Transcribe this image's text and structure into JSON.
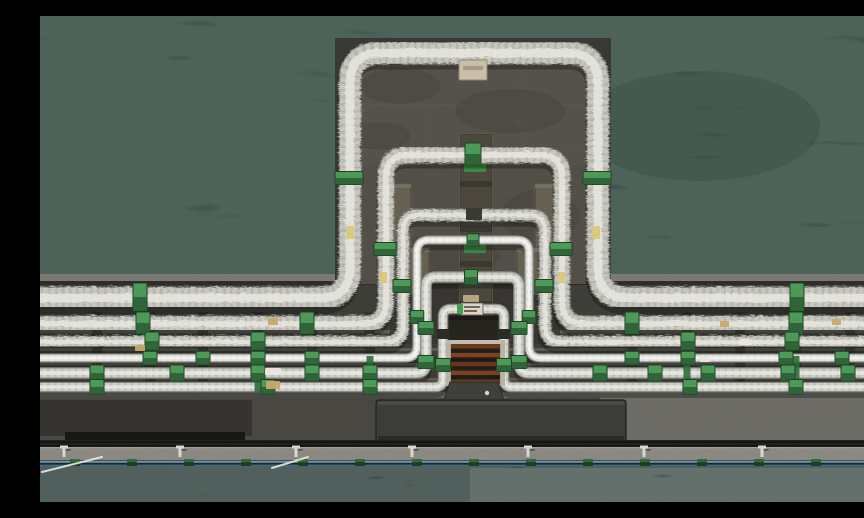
{
  "meta": {
    "description": "Aerial top-down photograph of six nested insulated pipeline expansion loops on a concrete pier platform surrounded by dark sea water, with green pipe clamps, a rusty grate rack, a dark maintenance structure and a walkway with blue railing"
  },
  "palette": {
    "waterTop": "#0d1513",
    "waterBottom": "#0a100e",
    "waterNoise": "#1b2a23",
    "pierBase": "#4f4d48",
    "curb": "#8a8882",
    "deckStrip": "#6e6c65",
    "platform": "#393833",
    "pad": "#8a867c",
    "padJoint": "#67645c",
    "padStain": "#5b584f",
    "pillar": "#7e7666",
    "pillarEdge": "#5f594c",
    "stripConcrete": "#857a62",
    "tagGreenBright": "#46a050",
    "tagGreenDark": "#35703d",
    "clampTop": "#4d9a58",
    "clampBottom": "#2a5c33",
    "clampOutline": "#1d4024",
    "connector": "#2f6b3a",
    "grateFrame": "#a8a49c",
    "grateTopBar": "#c2beb2",
    "structure": "#4a4a47",
    "structureHi": "#5e5e5b",
    "structureShade": "#343432",
    "structureOutline": "#2b2b29",
    "apron": "#57554f",
    "apronRight": "#6f6d66",
    "apronLeftDark": "#413f3b",
    "apronPatch": "#1d1c1a",
    "railGroove": "#232220",
    "railLine": "#121210",
    "walkway": "#b2afa7",
    "walkEdge": "#d5d2ca",
    "blueBase": "#1c262b",
    "blueLight": "#6d94ad",
    "blueDark": "#3f6b86",
    "footDark": "#1e3b28",
    "footGreen": "#2f6b3a",
    "post": "#d8d6d0",
    "cable": "#e8e6e0",
    "pipeStyles": {
      "insulated": {
        "out": "#7e7e78",
        "base": "#c7c7c0",
        "hi": "#e5e5df",
        "dash": "#a4a49c"
      },
      "bright": {
        "out": "#9a9a94",
        "base": "#e2e2de",
        "hi": "#f4f4f0",
        "dash": "#c8c8c4"
      },
      "small": {
        "out": "#8a8a84",
        "base": "#cfcfc8",
        "hi": "#e8e8e2",
        "dash": "#aeaea6"
      }
    },
    "labelYellow": "#d9c77a",
    "labelTan": "#c9a86a",
    "labelWhite": "#e8e6de",
    "labelBeige": "#c9bfa8",
    "grateStripes": [
      "#8f4e28",
      "#33291f",
      "#a35c30",
      "#2c241c",
      "#8a4a26",
      "#362b20",
      "#9c5a2e",
      "#2e261e",
      "#8f4e28"
    ]
  },
  "scene": {
    "size": {
      "w": 864,
      "h": 486
    },
    "water": {
      "topRect": [
        0,
        0,
        864,
        266
      ],
      "bottomRect": [
        0,
        450,
        864,
        36
      ],
      "swirl": [
        660,
        110,
        120,
        55
      ]
    },
    "pier": {
      "band": [
        0,
        258,
        864,
        174
      ],
      "curb": [
        0,
        258,
        864,
        7
      ],
      "curbShadow": [
        0,
        265,
        864,
        4
      ],
      "deckStrips": [
        [
          0,
          314,
          864,
          3.5
        ],
        [
          0,
          332,
          864,
          3
        ],
        [
          0,
          347,
          864,
          2.5
        ],
        [
          0,
          362,
          864,
          2.5
        ]
      ],
      "postColumns": [
        57,
        110,
        163,
        218,
        272,
        330,
        592,
        647,
        700,
        756,
        810
      ],
      "centerDark": [
        350,
        262,
        170,
        66
      ]
    },
    "platform": {
      "outer": [
        295,
        22,
        276,
        242
      ],
      "pad": [
        321,
        45,
        225,
        223
      ],
      "jointsY": [
        88,
        133,
        178,
        223
      ],
      "jointsX": [
        385,
        483
      ],
      "stainLower": [
        321,
        150,
        225,
        118
      ],
      "stains": [
        [
          360,
          70,
          40,
          18
        ],
        [
          470,
          95,
          55,
          22
        ],
        [
          340,
          120,
          30,
          14
        ],
        [
          500,
          200,
          40,
          26
        ],
        [
          400,
          240,
          60,
          20
        ]
      ]
    },
    "pillars": {
      "centerStrip": [
        420,
        118,
        32,
        210
      ],
      "stripBandsY": [
        165,
        210,
        245,
        285
      ],
      "stripTags": [
        [
          424,
          146,
          22,
          10,
          "bright"
        ],
        [
          424,
          196,
          22,
          9,
          "dark"
        ],
        [
          424,
          228,
          22,
          9,
          "bright"
        ],
        [
          424,
          262,
          20,
          8,
          "dark"
        ],
        [
          425,
          300,
          18,
          8,
          "bright"
        ]
      ],
      "sides": [
        [
          339,
          168,
          32,
          64
        ],
        [
          495,
          168,
          32,
          64
        ],
        [
          365,
          232,
          24,
          46
        ],
        [
          477,
          232,
          24,
          46
        ]
      ]
    },
    "pipes": [
      {
        "id": "L1",
        "w": 21,
        "runY": 281,
        "top": 36,
        "xl": 309,
        "xr": 557,
        "r": 30,
        "style": "insulated",
        "fur": true
      },
      {
        "id": "L2",
        "w": 15,
        "runY": 307,
        "top": 138,
        "xl": 345,
        "xr": 521,
        "r": 22,
        "style": "insulated",
        "fur": true
      },
      {
        "id": "L3",
        "w": 11,
        "runY": 325,
        "top": 198,
        "xl": 362,
        "xr": 504,
        "r": 16,
        "style": "insulated",
        "fur": true
      },
      {
        "id": "L4",
        "w": 6.5,
        "runY": 342,
        "top": 224,
        "xl": 377,
        "xr": 489,
        "r": 12,
        "style": "bright",
        "fur": false
      },
      {
        "id": "L5",
        "w": 9,
        "runY": 357,
        "top": 261,
        "xl": 386,
        "xr": 479,
        "r": 10,
        "style": "small",
        "fur": false
      },
      {
        "id": "L6",
        "w": 8,
        "runY": 371,
        "top": 293,
        "xl": 403,
        "xr": 464,
        "r": 8,
        "style": "small",
        "fur": false
      }
    ],
    "runClamps": [
      [
        100,
        757
      ],
      [
        103,
        267,
        592,
        756,
        856
      ],
      [
        112,
        218,
        648,
        752,
        856
      ],
      [
        110,
        163,
        218,
        272,
        592,
        648,
        746,
        802
      ],
      [
        57,
        137,
        218,
        272,
        330,
        560,
        615,
        668,
        748,
        808
      ],
      [
        57,
        228,
        330,
        650,
        756,
        846
      ]
    ],
    "legClamps": [
      [
        162
      ],
      [
        233
      ],
      [
        270
      ],
      [
        301
      ],
      [
        312,
        346
      ],
      [
        349
      ]
    ],
    "legDarkTags": [
      [],
      [],
      [],
      [],
      [],
      [
        318
      ]
    ],
    "connectors": [
      218,
      330,
      647,
      756
    ],
    "topFixtures": {
      "beigeBracket": [
        419,
        44,
        28,
        20
      ],
      "l6Sign": [
        421,
        287,
        22,
        12
      ],
      "l6SignGreen": [
        417,
        288,
        6,
        10
      ],
      "l6TanBlock": [
        423,
        279,
        16,
        7
      ]
    },
    "labels": [
      [
        306,
        210,
        8,
        13,
        "labelYellow"
      ],
      [
        552,
        210,
        8,
        13,
        "labelYellow"
      ],
      [
        340,
        256,
        7,
        11,
        "labelYellow"
      ],
      [
        518,
        256,
        7,
        11,
        "labelYellow"
      ],
      [
        228,
        302,
        10,
        7,
        "labelTan"
      ],
      [
        680,
        305,
        9,
        6,
        "labelTan"
      ],
      [
        225,
        352,
        16,
        7,
        "labelWhite"
      ],
      [
        700,
        323,
        12,
        6,
        "labelWhite"
      ],
      [
        226,
        365,
        14,
        8,
        "labelTan"
      ],
      [
        95,
        329,
        10,
        6,
        "labelTan"
      ],
      [
        792,
        303,
        9,
        6,
        "labelTan"
      ],
      [
        660,
        341,
        10,
        5,
        "labelWhite"
      ]
    ],
    "grate": {
      "backdrop": [
        398,
        300,
        70,
        70
      ],
      "frame": [
        406,
        324,
        59,
        46
      ],
      "inner": [
        411,
        328,
        49,
        40
      ]
    },
    "structure": {
      "stem": [
        [
          410,
          366
        ],
        [
          458,
          366
        ],
        [
          464,
          384
        ],
        [
          404,
          384
        ]
      ],
      "bar": [
        336,
        384,
        250,
        43
      ]
    },
    "apron": {
      "base": [
        0,
        372,
        864,
        60
      ],
      "deckEdge": [
        0,
        376,
        864,
        6
      ],
      "right": [
        560,
        374,
        304,
        54
      ],
      "leftDark": [
        0,
        384,
        212,
        36
      ],
      "patch": [
        25,
        416,
        180,
        13
      ]
    },
    "rails": {
      "groove": [
        0,
        424,
        864,
        8
      ],
      "lines": [
        [
          0,
          425.5,
          864,
          1.5
        ],
        [
          0,
          429,
          864,
          1.5
        ]
      ]
    },
    "walkway": {
      "band": [
        0,
        431,
        864,
        13
      ],
      "edge": [
        0,
        431,
        864,
        1.2
      ],
      "posts": [
        24,
        140,
        256,
        372,
        488,
        604,
        722,
        838
      ]
    },
    "blueRail": {
      "base": [
        0,
        444,
        864,
        8
      ],
      "light": [
        0,
        444.6,
        864,
        2.2
      ],
      "dark": [
        0,
        448.6,
        864,
        2.2
      ],
      "bottom": [
        0,
        451.2,
        864,
        1.6
      ],
      "feetStart": 35,
      "feetStep": 57,
      "feetCount": 15
    },
    "cables": [
      [
        2,
        456,
        62,
        441
      ],
      [
        232,
        452,
        268,
        441
      ]
    ]
  }
}
